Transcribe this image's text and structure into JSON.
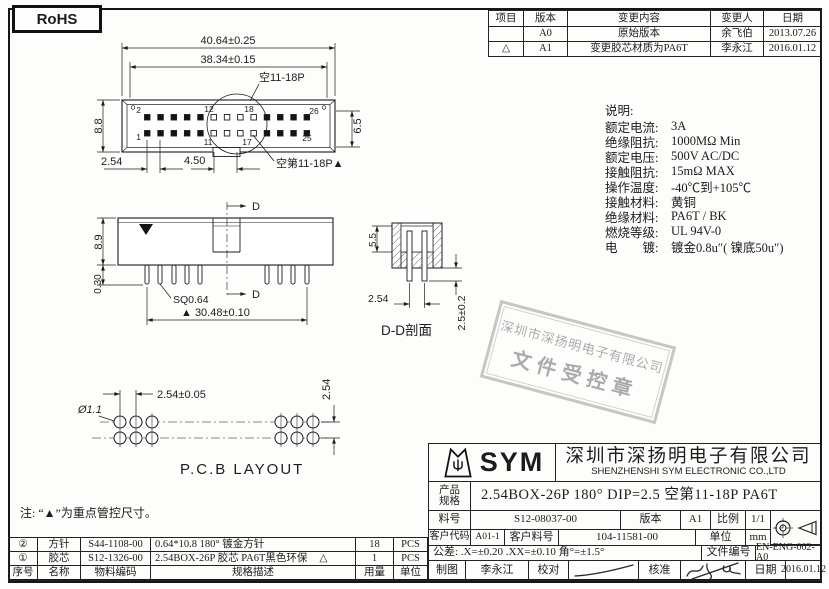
{
  "rohs": {
    "label": "RoHS"
  },
  "revision_table": {
    "headers": {
      "item": "项目",
      "version": "版本",
      "content": "变更内容",
      "by": "变更人",
      "date": "日期"
    },
    "rows": [
      {
        "item": "",
        "version": "A0",
        "content": "原始版本",
        "by": "余飞伯",
        "date": "2013.07.26"
      },
      {
        "item": "△",
        "version": "A1",
        "content": "变更胶芯材质为PA6T",
        "by": "李永江",
        "date": "2016.01.12"
      }
    ]
  },
  "specs": {
    "title": "说明:",
    "items": [
      {
        "label": "额定电流:",
        "value": "3A"
      },
      {
        "label": "绝缘阻抗:",
        "value": "1000MΩ Min"
      },
      {
        "label": "额定电压:",
        "value": "500V AC/DC"
      },
      {
        "label": "接触阻抗:",
        "value": "15mΩ MAX"
      },
      {
        "label": "操作温度:",
        "value": "-40℃到+105℃"
      },
      {
        "label": "接触材料:",
        "value": "黄铜"
      },
      {
        "label": "绝缘材料:",
        "value": "PA6T / BK"
      },
      {
        "label": "燃烧等级:",
        "value": "UL 94V-0"
      },
      {
        "label": "电　　镀:",
        "value": "镀金0.8u″( 镍底50u″)"
      }
    ]
  },
  "stamp": {
    "line1": "深圳市深扬明电子有限公司",
    "line2": "文件受控章"
  },
  "note": "注: “▲”为重点管控尺寸。",
  "drawings": {
    "top_view": {
      "dim_overall": "40.64±0.25",
      "dim_inner": "38.34±0.15",
      "dim_height": "8.8",
      "dim_inner_height": "6.5",
      "dim_pitch": "2.54",
      "dim_gap": "4.50",
      "callout_top": "空11-18P",
      "callout_bottom": "空第11-18P▲",
      "pin2": "2",
      "pin1": "1",
      "pin12": "12",
      "pin11": "11",
      "pin18": "18",
      "pin17": "17",
      "pin26": "26",
      "pin25": "25"
    },
    "side_view": {
      "dim_height": "8.9",
      "dim_standoff": "0.30",
      "pin_label": "SQ0.64",
      "dim_span": "▲ 30.48±0.10",
      "section_mark": "D"
    },
    "section_view": {
      "dim_depth": "5.5",
      "dim_pitch": "2.54",
      "dim_tail": "2.5±0.2",
      "title": "D-D剖面"
    },
    "pcb_layout": {
      "dim_pitch": "2.54±0.05",
      "dim_hole": "Ø1.1",
      "dim_row": "2.54",
      "title": "P.C.B LAYOUT"
    }
  },
  "title_block": {
    "logo_text": "SYM",
    "company_cn": "深圳市深扬明电子有限公司",
    "company_en": "SHENZHENSHI SYM ELECTRONIC CO.,LTD",
    "product_label_1": "产品",
    "product_label_2": "规格",
    "product_value": "2.54BOX-26P  180° DIP=2.5 空第11-18P PA6T",
    "part_no_label": "料号",
    "part_no_value": "S12-08037-00",
    "version_label": "版本",
    "version_value": "A1",
    "scale_label": "比例",
    "scale_value": "1/1",
    "customer_code_label": "客户代码",
    "customer_code_value": "A01-1",
    "customer_part_label": "客户料号",
    "customer_part_value": "104-11581-00",
    "unit_label": "单位",
    "unit_value": "mm",
    "tolerance": "公差: .X=±0.20  .XX=±0.10  角°=±1.5°",
    "doc_no_label": "文件编号",
    "doc_no_value": "EN-ENG-002-A0",
    "drawn_label": "制图",
    "drawn_value": "李永江",
    "check_label": "校对",
    "approve_label": "核准",
    "date_label": "日期",
    "date_value": "2016.01.12"
  },
  "bom": {
    "headers": {
      "no": "序号",
      "name": "名称",
      "code": "物料编码",
      "desc": "规格描述",
      "qty": "用量",
      "unit": "单位"
    },
    "rows": [
      {
        "no": "②",
        "name": "方针",
        "code": "S44-1108-00",
        "desc": "0.64*10.8 180° 镀金方针",
        "mark": "",
        "qty": "18",
        "unit": "PCS"
      },
      {
        "no": "①",
        "name": "胶芯",
        "code": "S12-1326-00",
        "desc": "2.54BOX-26P 胶芯 PA6T黑色环保",
        "mark": "△",
        "qty": "1",
        "unit": "PCS"
      }
    ]
  },
  "colors": {
    "line": "#1c1c1c",
    "stamp_gray": "#8f8f8f"
  }
}
